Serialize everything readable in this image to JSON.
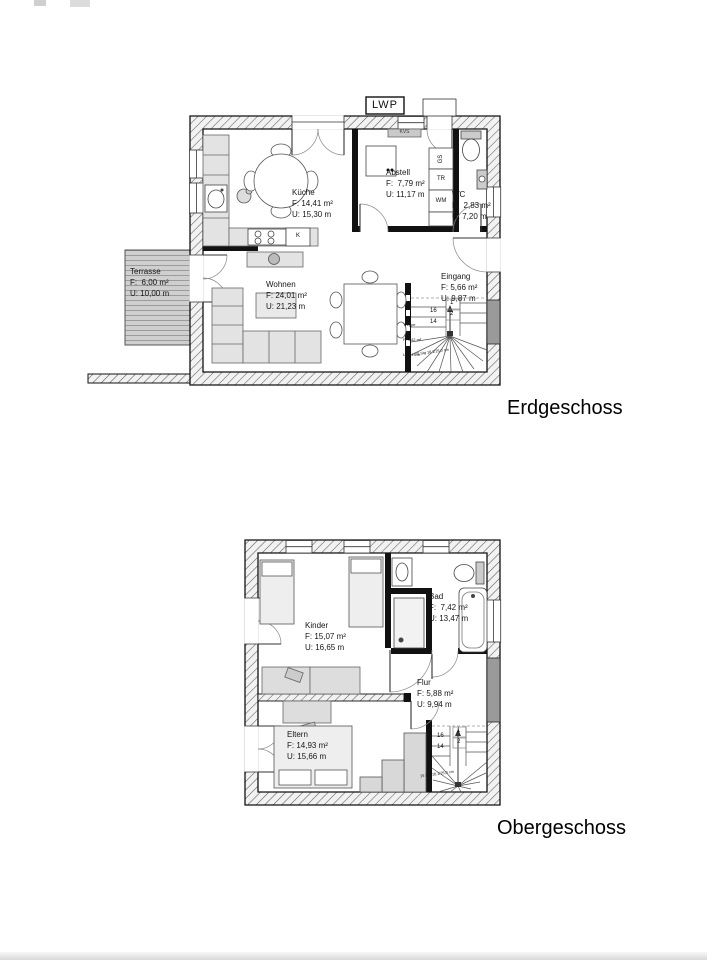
{
  "titles": {
    "ground": "Erdgeschoss",
    "upper": "Obergeschoss"
  },
  "ground_floor": {
    "lwp": "LWP",
    "kvs": "KVS",
    "rooms": {
      "kueche": {
        "name": "Küche",
        "f": "F: 14,41 m²",
        "u": "U: 15,30 m"
      },
      "abstell": {
        "name": "Abstell",
        "f": "F:  7,79 m²",
        "u": "U: 11,17 m"
      },
      "wc": {
        "name": "WC",
        "f": "F:  2,83 m²",
        "u": "U: 7,20 m"
      },
      "eingang": {
        "name": "Eingang",
        "f": "F: 5,66 m²",
        "u": "U: 9,87 m"
      },
      "wohnen": {
        "name": "Wohnen",
        "f": "F: 24,01 m²",
        "u": "U: 21,23 m"
      },
      "terrasse": {
        "name": "Terrasse",
        "f": "F:  6,00 m²",
        "u": "U: 10,00 m"
      },
      "treppe": {
        "name": "Treppe",
        "f": "F: 4,42 m²",
        "u": "U: 6,19 m"
      }
    },
    "labels": {
      "gs": "GS",
      "tr": "TR",
      "wm": "WM",
      "k": "K"
    },
    "stairs": {
      "n16": "16",
      "n14": "14",
      "n1": "1",
      "n2": "2",
      "note": "15 Stg 18,1/25,0 cm"
    }
  },
  "upper_floor": {
    "rooms": {
      "kinder": {
        "name": "Kinder",
        "f": "F: 15,07 m²",
        "u": "U: 16,65 m"
      },
      "bad": {
        "name": "Bad",
        "f": "F:  7,42 m²",
        "u": "U: 13,47 m"
      },
      "flur": {
        "name": "Flur",
        "f": "F: 5,88 m²",
        "u": "U: 9,94 m"
      },
      "eltern": {
        "name": "Eltern",
        "f": "F: 14,93 m²",
        "u": "U: 15,66 m"
      }
    },
    "stairs": {
      "n16": "16",
      "n14": "14",
      "n1": "1",
      "n2": "2",
      "note": "15 Stg 18,1/25,0 cm"
    }
  }
}
